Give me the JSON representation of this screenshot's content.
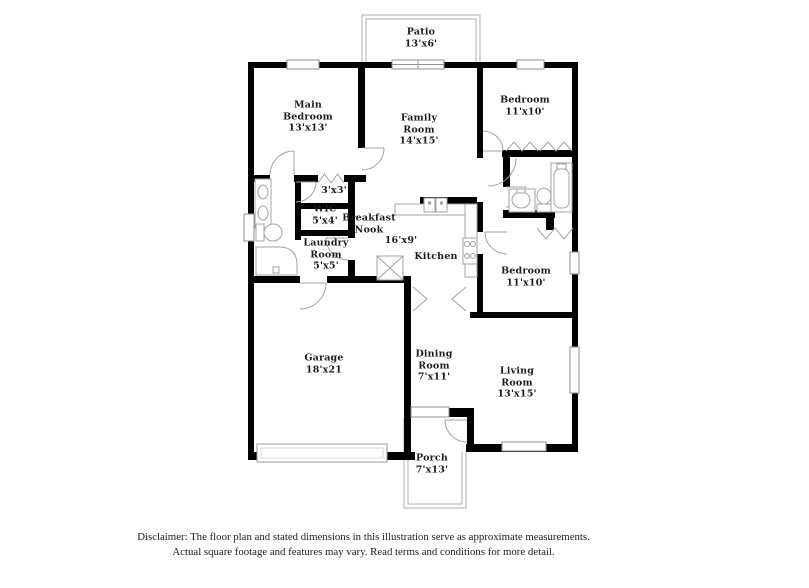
{
  "rooms": {
    "patio": {
      "name": "Patio",
      "dims": "13'x6'"
    },
    "main_bedroom": {
      "name": "Main Bedroom",
      "dims": "13'x13'"
    },
    "family_room": {
      "name": "Family Room",
      "dims": "14'x15'"
    },
    "bedroom_top": {
      "name": "Bedroom",
      "dims": "11'x10'"
    },
    "closet": {
      "dims": "3'x3'"
    },
    "wic": {
      "name": "WIC",
      "dims": "5'x4'"
    },
    "breakfast_nook": {
      "name": "Breakfast Nook"
    },
    "kitchen": {
      "name": "Kitchen",
      "dims": "16'x9'"
    },
    "laundry": {
      "name": "Laundry Room",
      "dims": "5'x5'"
    },
    "bedroom_right": {
      "name": "Bedroom",
      "dims": "11'x10'"
    },
    "garage": {
      "name": "Garage",
      "dims": "18'x21"
    },
    "dining": {
      "name": "Dining Room",
      "dims": "7'x11'"
    },
    "living": {
      "name": "Living Room",
      "dims": "13'x15'"
    },
    "porch": {
      "name": "Porch",
      "dims": "7'x13'"
    }
  },
  "disclaimer": {
    "line1": "Disclaimer: The floor plan and stated dimensions in this illustration serve as approximate measurements.",
    "line2": "Actual square footage and features may vary. Read terms and conditions for more detail."
  }
}
